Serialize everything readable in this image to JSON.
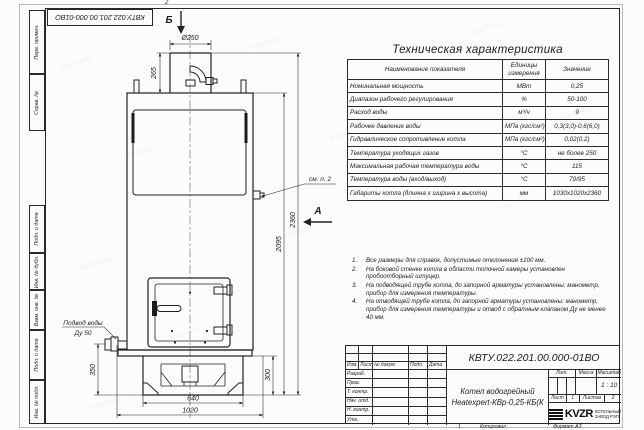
{
  "sheet": {
    "corner_number": "КВТУ.022.201.00.000-01ВО",
    "fold_mark_top": "2",
    "copy_mark": "1",
    "copied_label": "Копировал",
    "format_label": "Формат А3",
    "watermark_text": "kotel-kv.kz",
    "margin_stamps": [
      "Перв. примен.",
      "Справ. №",
      "Подп. и дата",
      "Инв. № дубл.",
      "Взам. инв. №",
      "Подп. и дата",
      "Инв. № подл."
    ]
  },
  "drawing": {
    "view_b": "Б",
    "view_a": "А",
    "callout_note2": "см. п. 2",
    "water_inlet_line1": "Подвод воды",
    "water_inlet_line2": "Ду 50",
    "dims": {
      "chimney_dia": "Ø250",
      "chimney_h": "265",
      "body_h": "2095",
      "total_h": "2360",
      "inlet_h": "350",
      "base_h": "300",
      "base_w": "640",
      "overall_w": "1020"
    }
  },
  "spec_table": {
    "title": "Техническая характеристика",
    "col_name": "Наименование показателя",
    "col_units": "Единицы измерения",
    "col_value": "Значение",
    "rows": [
      {
        "name": "Номинальная мощность",
        "unit": "МВт",
        "value": "0,25"
      },
      {
        "name": "Диапазон рабочего регулирования",
        "unit": "%",
        "value": "50-100"
      },
      {
        "name": "Расход воды",
        "unit": "м³/ч",
        "value": "9"
      },
      {
        "name": "Рабочее давление воды",
        "unit": "МПа (кгс/см²)",
        "value": "0,3(3,0)-0,6(6,0)"
      },
      {
        "name": "Гидравлическое сопротивление котла",
        "unit": "МПа (кгс/см²)",
        "value": "0,02(0,2)"
      },
      {
        "name": "Температура уходящих газов",
        "unit": "°С",
        "value": "не более 250"
      },
      {
        "name": "Максимальная рабочая температура воды",
        "unit": "°С",
        "value": "115"
      },
      {
        "name": "Температура воды (вход/выход)",
        "unit": "°С",
        "value": "70/95"
      },
      {
        "name": "Габариты котла (длинна х ширина х высота)",
        "unit": "мм",
        "value": "1030х1020х2360"
      }
    ]
  },
  "notes": {
    "items": [
      {
        "num": "1.",
        "text": "Все размеры для справок, допустимые отклонения ±100 мм."
      },
      {
        "num": "2.",
        "text": "На боковой стенке котла в области топочной камеры установлен пробоотборный штуцер."
      },
      {
        "num": "3.",
        "text": "На подводящей трубе котла, до запорной арматуры установлены: манометр, прибор для измерения температуры."
      },
      {
        "num": "4.",
        "text": "На отводящей трубе котла, до запорной арматуры установлены: манометр, прибор для измерения температуры и отвод с обратным клапаном Ду не менее 40 мм."
      }
    ]
  },
  "title_block": {
    "doc_number": "КВТУ.022.201.00.000-01ВО",
    "name_line1": "Котел водогрейный",
    "name_line2": "Heatexpert-КВр-0,25-КБ(К",
    "cols": {
      "izm": "Изм.",
      "list": "Лист",
      "doc": "№ докум.",
      "podp": "Подп.",
      "data": "Дата"
    },
    "rows": [
      "Разраб.",
      "Пров.",
      "Т. контр.",
      "Нач. отд.",
      "Н. контр.",
      "Утв."
    ],
    "lit_label": "Лит.",
    "mass_label": "Масса",
    "scale_label": "Масштаб",
    "scale_value": "1 : 10",
    "sheet_label": "Лист",
    "sheet_value": "1",
    "sheets_label": "Листов",
    "sheets_value": "2",
    "logo_text": "KVZR",
    "company_line1": "КОТЕЛЬНЫЙ",
    "company_line2": "ЗАВОД  РЭП"
  }
}
